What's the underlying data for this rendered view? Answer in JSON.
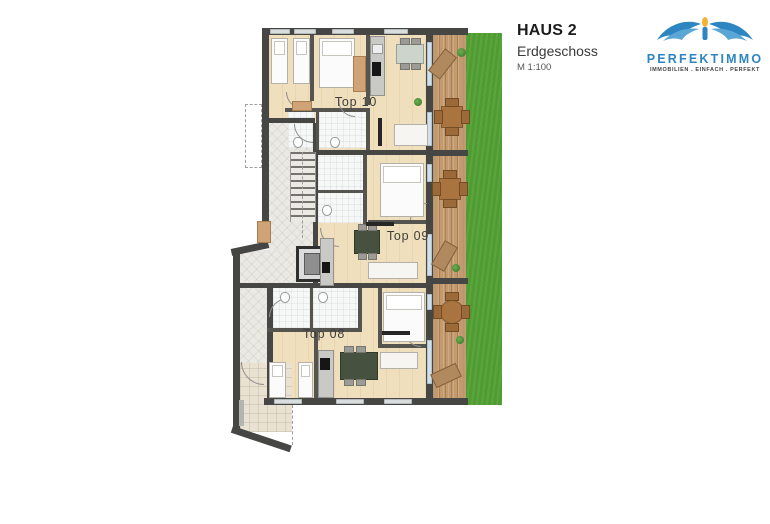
{
  "header": {
    "title": "HAUS 2",
    "subtitle": "Erdgeschoss",
    "scale": "M 1:100"
  },
  "logo": {
    "brand": "PERFEKTIMMO",
    "tagline": "IMMOBILIEN . EINFACH . PERFEKT"
  },
  "plan": {
    "units": [
      {
        "id": "top10",
        "label": "Top 10"
      },
      {
        "id": "top09",
        "label": "Top 09"
      },
      {
        "id": "top08",
        "label": "Top 08"
      }
    ],
    "features": [
      "staircase",
      "elevator",
      "terraces",
      "lawn",
      "entrance-patio"
    ],
    "colors": {
      "wall": "#464644",
      "wood_floor": "#f0dfbc",
      "corridor_tile": "#ebe9e3",
      "bathroom": "#f6f8f8",
      "deck_wood": "#c29a6d",
      "grass": "#4f9d31",
      "glazing": "#cfe0ea",
      "logo_blue": "#2e86c1",
      "flame_yellow": "#f2b233"
    }
  }
}
